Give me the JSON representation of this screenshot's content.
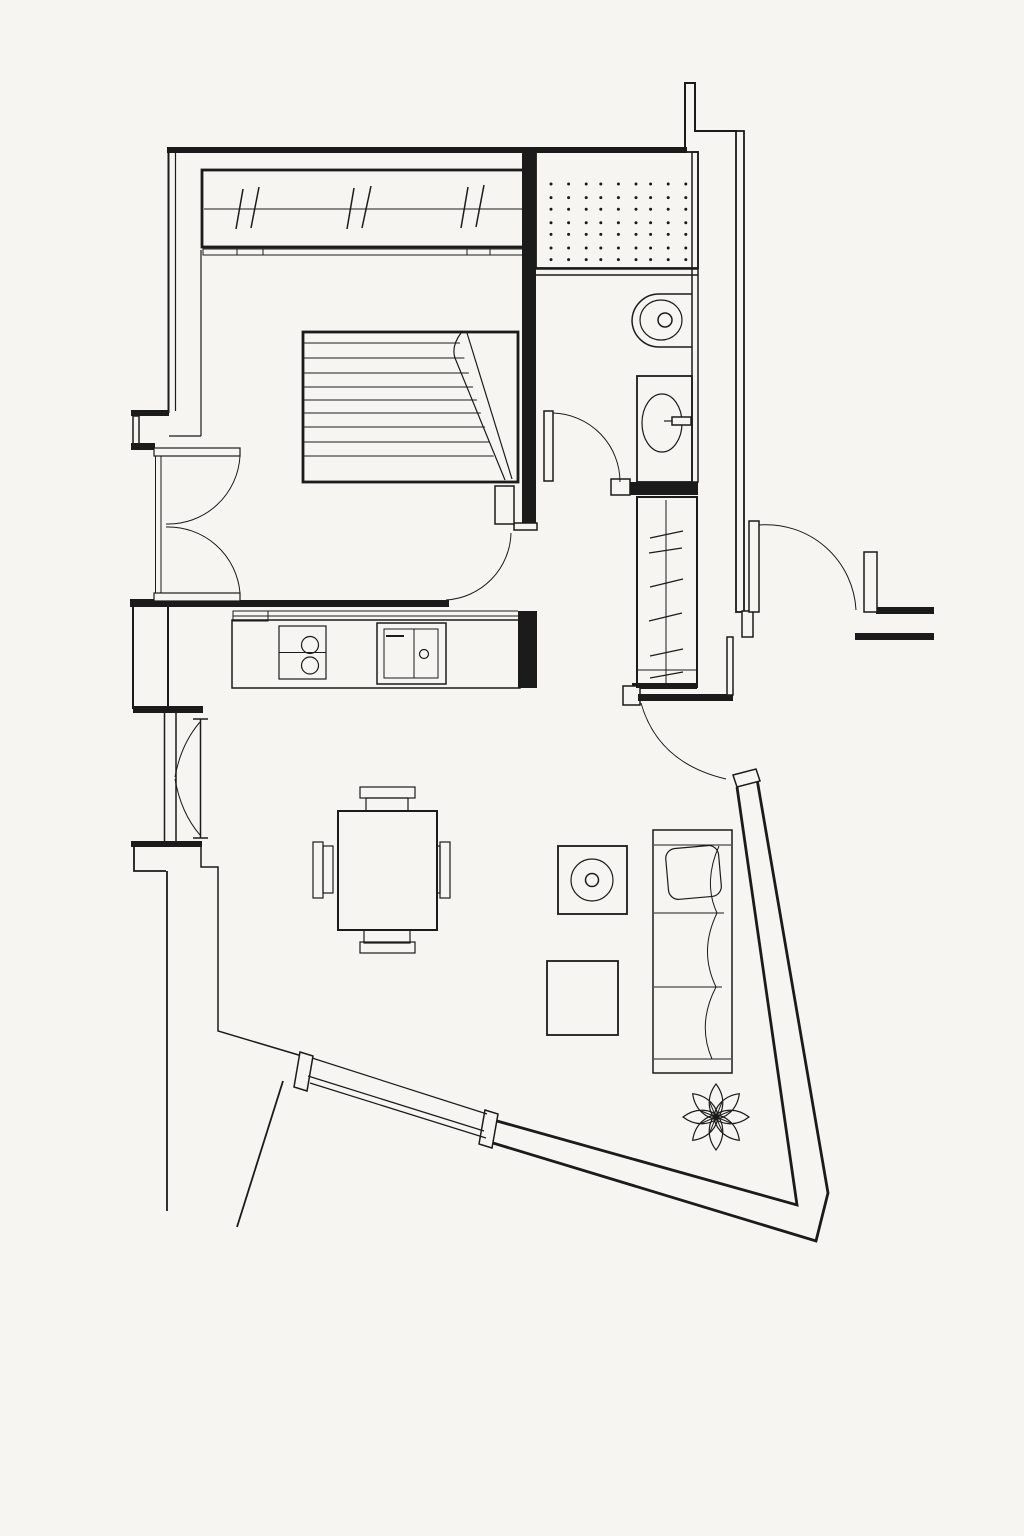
{
  "canvas": {
    "width": 1024,
    "height": 1536,
    "paper_color": "#f6f5f2",
    "ink_color": "#1b1b1b"
  },
  "drawing": {
    "kind": "architectural-floor-plan-line-drawing",
    "rooms": [
      "bedroom",
      "bathroom",
      "hallway",
      "kitchen",
      "living-dining-area",
      "entry"
    ],
    "shower_dots": {
      "rows": 7,
      "cols": 9,
      "start_x": 552,
      "start_y": 184,
      "step_x": 16.6,
      "step_y": 12.6,
      "radius": 1.5
    }
  },
  "symbols": {
    "wardrobe": "sliding-door-wardrobe-symbol",
    "bed": "double-bed-with-folded-blanket-symbol",
    "shower": "shower-tray-dotted-tile-symbol",
    "toilet": "toilet-symbol",
    "washbasin": "washbasin-cabinet-symbol",
    "closet": "hall-closet-with-clothes-rail-symbol",
    "kitchen_counter": "kitchen-counter-symbol",
    "cooktop": "two-burner-cooktop-symbol",
    "kitchen_sink": "kitchen-sink-symbol",
    "dining_table": "square-dining-table-with-four-chairs-symbol",
    "media_unit": "speaker-unit-symbol",
    "coffee_table": "coffee-table-symbol",
    "sofa": "sofa-with-cushion-symbol",
    "plant": "potted-plant-symbol",
    "double_swing_door": "double-swing-door-symbol",
    "bedroom_door": "bedroom-door-swing-symbol",
    "bathroom_door": "bathroom-door-swing-symbol",
    "hall_door": "hall-to-living-door-swing-symbol",
    "entrance_door": "entrance-door-swing-symbol",
    "casement_window": "double-casement-window-symbol",
    "panorama_window": "angled-panorama-window-symbol"
  }
}
